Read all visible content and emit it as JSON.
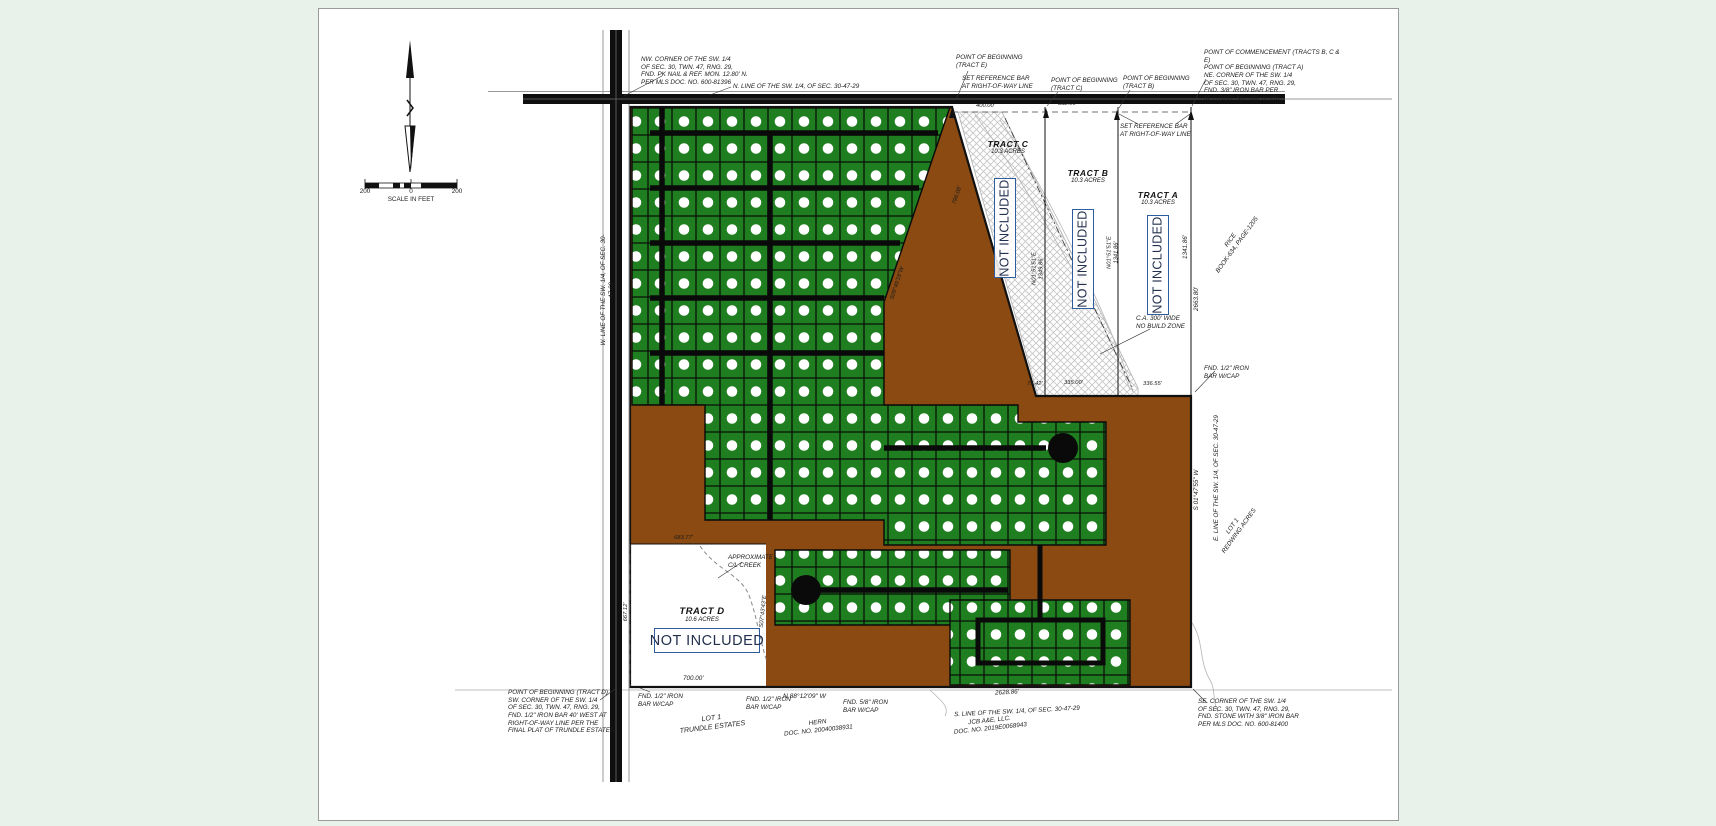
{
  "scale_bar": {
    "left": "200",
    "zero": "0",
    "right": "200",
    "caption": "SCALE IN FEET"
  },
  "tracts": {
    "c": {
      "name": "TRACT C",
      "acres": "10.3 ACRES"
    },
    "b": {
      "name": "TRACT B",
      "acres": "10.3 ACRES"
    },
    "a": {
      "name": "TRACT A",
      "acres": "10.3 ACRES"
    },
    "d": {
      "name": "TRACT D",
      "acres": "10.6 ACRES"
    },
    "not_included": "NOT INCLUDED"
  },
  "corners": {
    "nw": "NW. CORNER OF THE SW. 1/4\nOF SEC. 30, TWN. 47, RNG. 29,\nFND. PK NAIL & REF. MON. 12.80' N.\nPER MLS DOC. NO. 600-81396",
    "ne": "POINT OF COMMENCEMENT (TRACTS B, C & E)\nPOINT OF BEGINNING (TRACT A)\nNE. CORNER OF THE SW. 1/4\nOF SEC. 30, TWN. 47, RNG. 29,\nFND. 3/8\" IRON BAR PER\nMLS DOC. NO. 600-81396",
    "sw": "POINT OF BEGINNING (TRACT D)\nSW. CORNER OF THE SW. 1/4\nOF SEC. 30, TWN. 47, RNG. 29,\nFND. 1/2\" IRON BAR 40' WEST AT\nRIGHT-OF-WAY LINE PER THE\nFINAL PLAT OF TRUNDLE ESTATES",
    "se": "SE. CORNER OF THE SW. 1/4\nOF SEC. 30, TWN. 47, RNG. 29,\nFND. STONE WITH 3/8\" IRON BAR\nPER MLS DOC. NO. 600-81400"
  },
  "section_lines": {
    "north": "N. LINE OF THE SW. 1/4, OF SEC. 30-47-29",
    "west": "W. LINE OF THE SW. 1/4, OF SEC. 30-47-29",
    "east": "E. LINE OF THE SW. 1/4, OF SEC. 30-47-29",
    "south": "S. LINE OF THE SW. 1/4, OF SEC. 30-47-29"
  },
  "points": {
    "pob_e": "POINT OF BEGINNING\n(TRACT E)",
    "pob_c": "POINT OF BEGINNING\n(TRACT C)",
    "pob_b": "POINT OF BEGINNING\n(TRACT B)",
    "set_ref_bar": "SET REFERENCE BAR\nAT RIGHT-OF-WAY LINE"
  },
  "monuments": {
    "fnd_half_iron": "FND. 1/2\" IRON\nBAR W/CAP",
    "fnd_58_iron": "FND. 5/8\" IRON\nBAR W/CAP"
  },
  "dimensions": {
    "d400": "400.00'",
    "d332": "332.00'",
    "d796": "796.08'",
    "d1349_brg": "N01°51'51\"E\n1349.86'",
    "d1341_brg": "N01°51'51\"E\n1341.86'",
    "d1341": "1341.86'",
    "d2663": "2663.80'",
    "d7542": "75.42'",
    "d335": "335.00'",
    "d33655": "336.55'",
    "d68377": "683.77'",
    "d66712": "667.12'",
    "d700": "700.00'",
    "d2628": "2628.86'",
    "brg_s0949": "S09°49'18\"W",
    "brg_s0147": "S 01°47'55\" W",
    "brg_s0743": "S07°43'43\"E",
    "brg_n8812": "N 88°12'09\" W"
  },
  "notes": {
    "no_build": "C.A. 300' WIDE\nNO BUILD ZONE",
    "creek": "APPROXIMATE\nC/L CREEK",
    "rice": "RICE\nBOOK-634, PAGE-1205",
    "lot1_redwing": "LOT 1\nREDWING ACRES",
    "lot1_trundle": "LOT 1\nTRUNDLE ESTATES",
    "hern": "HERN\nDOC. NO. 20040038931",
    "jcb": "JCB A&E, LLC.\nDOC. NO. 2019E0068943"
  },
  "colors": {
    "lot_green": "#1f7e1f",
    "open_space_brown": "#8a4a12",
    "annotation_blue": "#2d5d9f",
    "line_black": "#111111",
    "page_bg": "#e8f1ea"
  }
}
